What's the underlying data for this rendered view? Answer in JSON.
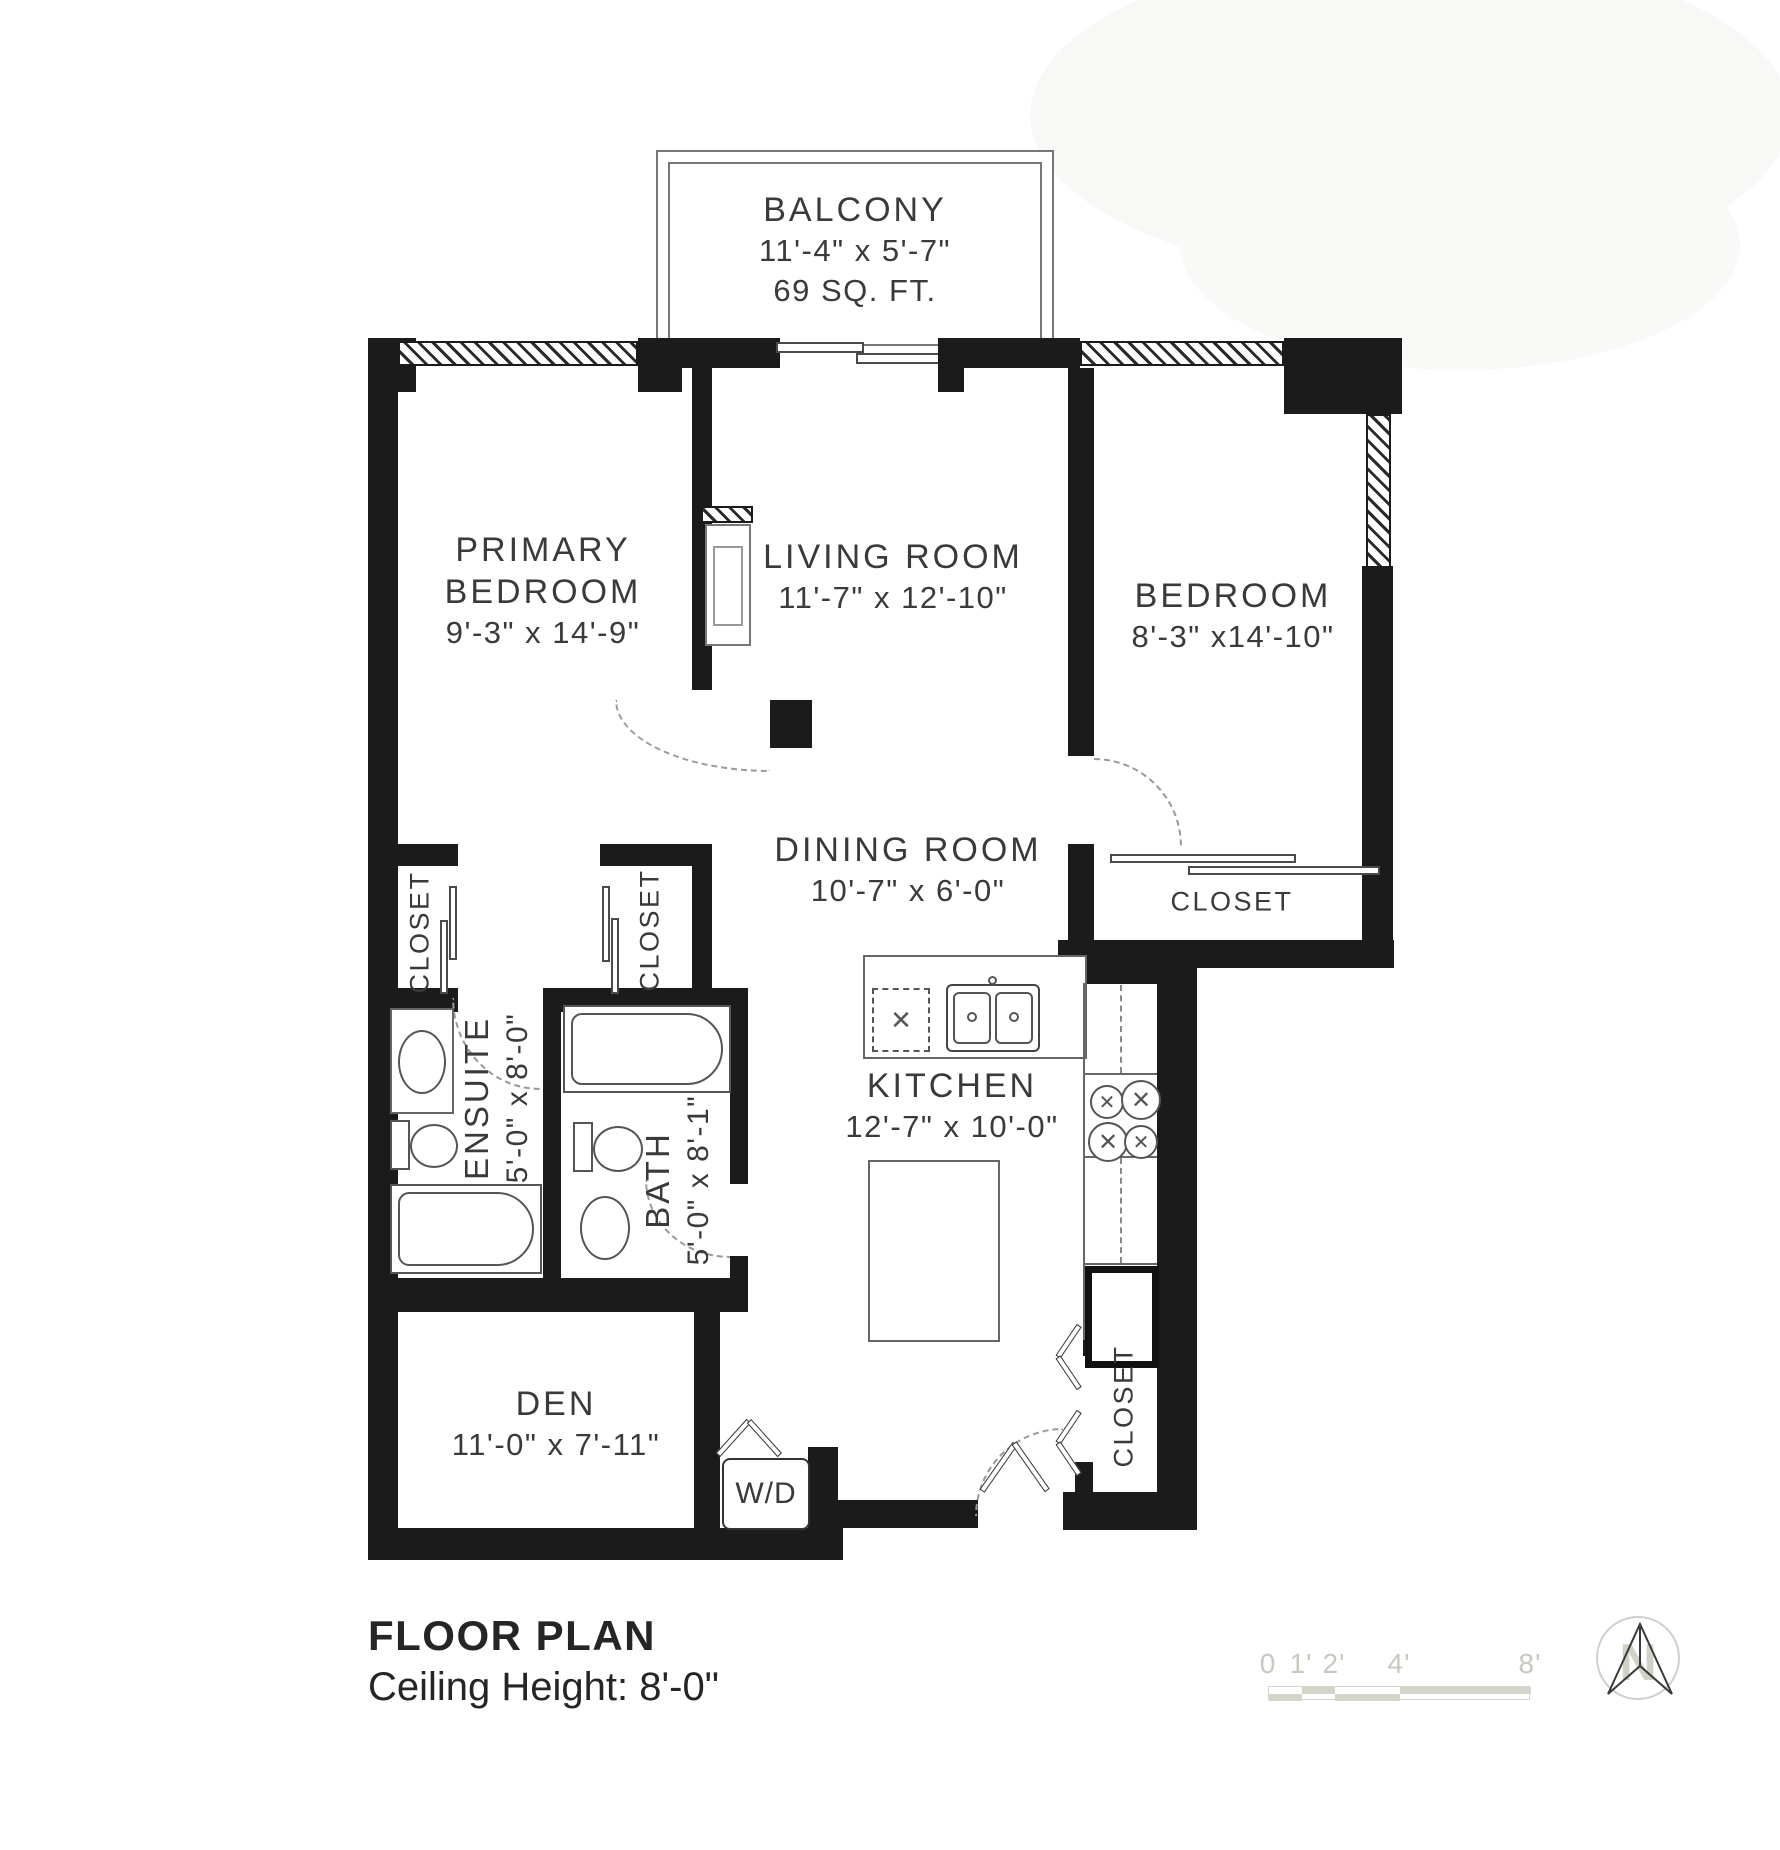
{
  "rooms": {
    "balcony": {
      "name": "BALCONY",
      "dims": "11'-4\" x 5'-7\"",
      "area": "69 SQ. FT."
    },
    "primary_bedroom": {
      "name_line1": "PRIMARY",
      "name_line2": "BEDROOM",
      "dims": "9'-3\" x 14'-9\""
    },
    "living_room": {
      "name": "LIVING ROOM",
      "dims": "11'-7\" x 12'-10\""
    },
    "bedroom": {
      "name": "BEDROOM",
      "dims": "8'-3\" x14'-10\""
    },
    "dining_room": {
      "name": "DINING ROOM",
      "dims": "10'-7\" x 6'-0\""
    },
    "kitchen": {
      "name": "KITCHEN",
      "dims": "12'-7\" x 10'-0\""
    },
    "den": {
      "name": "DEN",
      "dims": "11'-0\" x 7'-11\""
    },
    "ensuite": {
      "name": "ENSUITE",
      "dims": "5'-0\" x 8'-0\""
    },
    "bath": {
      "name": "BATH",
      "dims": "5'-0\" x 8'-1\""
    },
    "closets": [
      "CLOSET",
      "CLOSET",
      "CLOSET",
      "CLOSET"
    ],
    "laundry": {
      "name": "W/D"
    }
  },
  "footer": {
    "title": "FLOOR PLAN",
    "ceiling_height": "Ceiling Height: 8'-0\""
  },
  "scale_bar": {
    "labels": [
      "0",
      "1'",
      "2'",
      "4'",
      "8'"
    ]
  },
  "compass": {
    "label": "N"
  },
  "icons": {
    "burner_cross": "✕",
    "appliance_cross": "✕"
  },
  "colors": {
    "walls": "#1b1b1b",
    "fixture_lines": "#555555",
    "text": "#3a3a3a",
    "scale_fill": "#d5d4ca",
    "scale_text": "#c9c8bf"
  }
}
